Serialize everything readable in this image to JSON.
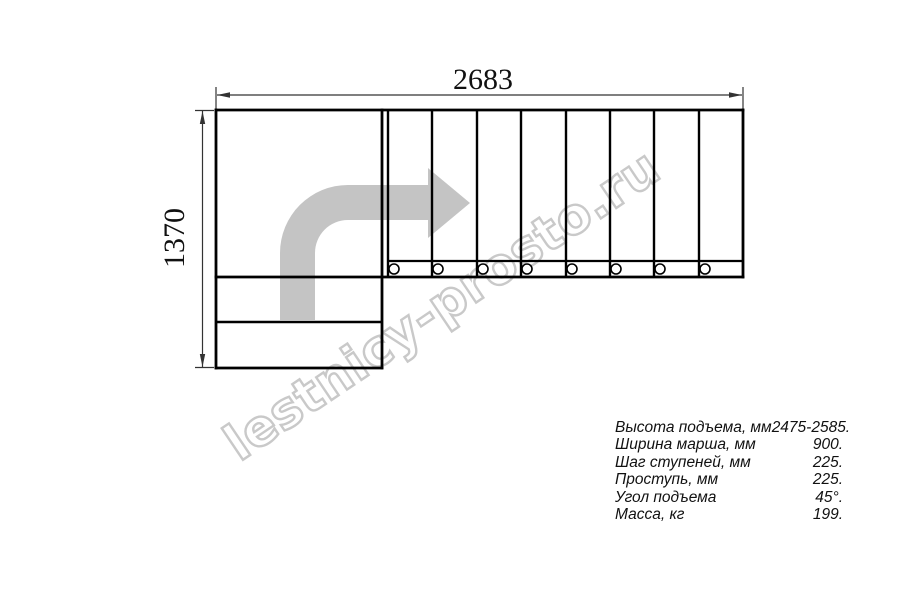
{
  "drawing": {
    "width_dim": "2683",
    "height_dim": "1370",
    "colors": {
      "line": "#000000",
      "dimension": "#333333",
      "arrow": "#c4c4c4",
      "watermark": "#c9c9c9"
    }
  },
  "watermark": {
    "text": "lestnicy-prosto.ru"
  },
  "specs": {
    "rows": [
      {
        "label": "Высота подъема, мм",
        "value": "2475-2585."
      },
      {
        "label": "Ширина марша, мм",
        "value": "900."
      },
      {
        "label": "Шаг ступеней, мм",
        "value": "225."
      },
      {
        "label": "Проступь, мм",
        "value": "225."
      },
      {
        "label": "Угол подъема",
        "value": "45°."
      },
      {
        "label": "Масса, кг",
        "value": "199."
      }
    ]
  }
}
